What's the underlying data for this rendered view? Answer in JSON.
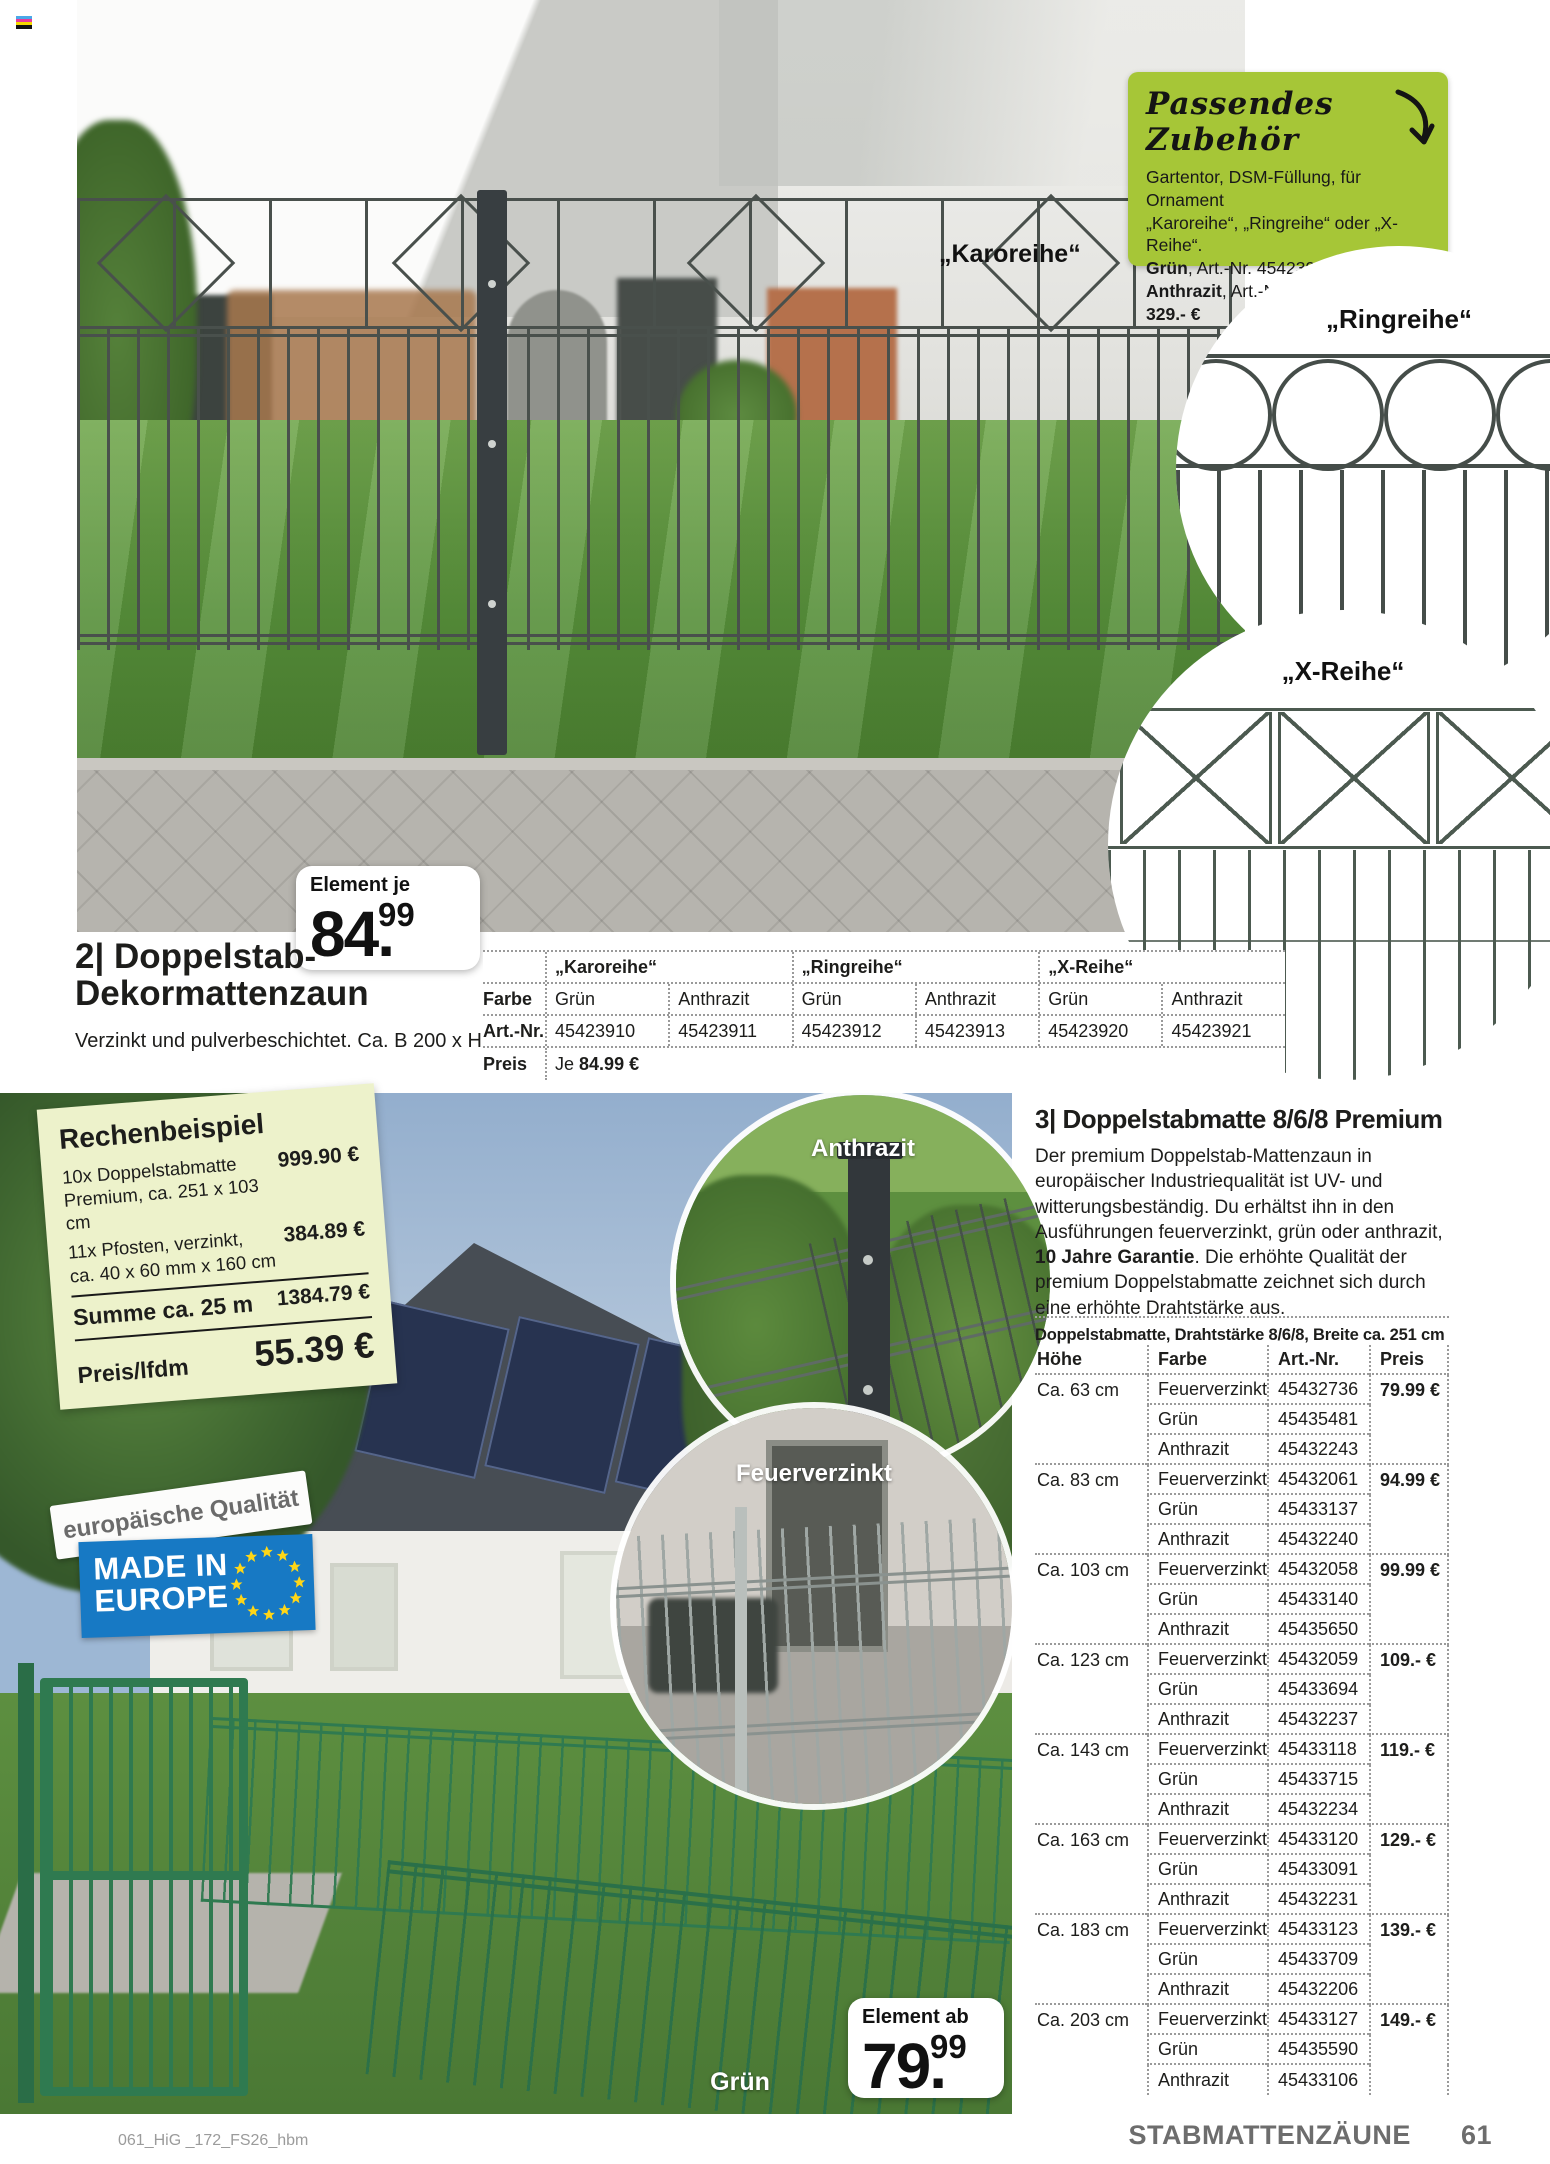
{
  "accent": {
    "lime_green": "#a6c637",
    "eu_blue": "#1779c4",
    "fence_green": "#2f7a50"
  },
  "accessory_box": {
    "title": "Passendes Zubehör",
    "line1": "Gartentor, DSM-Füllung, für Ornament",
    "line2": "„Karoreihe“, „Ringreihe“ oder „X-Reihe“.",
    "green_label": "Grün",
    "green_rest": ", Art.-Nr. 45423922",
    "anthracite_label": "Anthrazit",
    "anthracite_rest": ", Art.-Nr. 45423923, je ",
    "price_bold": "329.- €"
  },
  "photo_labels": {
    "karoreihe": "„Karoreihe“",
    "ringreihe": "„Ringreihe“",
    "xreihe": "„X-Reihe“",
    "anthrazit": "Anthrazit",
    "feuerverzinkt": "Feuerverzinkt",
    "gruen": "Grün"
  },
  "badge1": {
    "label": "Element je",
    "int": "84",
    "dec": "99"
  },
  "badge2": {
    "label": "Element ab",
    "int": "79",
    "dec": "99"
  },
  "product2": {
    "title_line1": "2| Doppelstab-",
    "title_line2": "Dekormattenzaun",
    "subtitle": "Verzinkt und pulverbeschichtet. Ca. B 200 x H 100 cm.",
    "table": {
      "row_labels": {
        "farbe": "Farbe",
        "artnr": "Art.-Nr.",
        "preis": "Preis"
      },
      "groups": [
        "„Karoreihe“",
        "„Ringreihe“",
        "„X-Reihe“"
      ],
      "farbe": [
        "Grün",
        "Anthrazit",
        "Grün",
        "Anthrazit",
        "Grün",
        "Anthrazit"
      ],
      "artnr": [
        "45423910",
        "45423911",
        "45423912",
        "45423913",
        "45423920",
        "45423921"
      ],
      "preis_prefix": "Je ",
      "preis_value": "84.99 €"
    }
  },
  "rechenbeispiel": {
    "title": "Rechenbeispiel",
    "item1_l1": "10x Doppelstabmatte",
    "item1_l2": "Premium, ca. 251 x 103 cm",
    "item1_price": "999.90 €",
    "item2_l1": "11x Pfosten, verzinkt,",
    "item2_l2": "ca. 40 x 60 mm x 160 cm",
    "item2_price": "384.89 €",
    "summe_label": "Summe ca. 25 m",
    "summe_price": "1384.79 €",
    "final_label": "Preis/lfdm",
    "final_price": "55.39 €"
  },
  "quality": {
    "band": "europäische Qualität",
    "badge_line1": "MADE IN",
    "badge_line2": "EUROPE"
  },
  "product3": {
    "title": "3| Doppelstabmatte 8/6/8 Premium",
    "desc_before": "Der premium Doppelstab-Mattenzaun in europäischer Industriequalität ist UV- und witterungsbeständig. Du erhältst ihn in den Ausführungen feuerverzinkt, grün oder anthrazit, ",
    "desc_bold": "10 Jahre Garantie",
    "desc_after": ". Die erhöhte Qualität der premium Doppelstabmatte zeichnet sich durch eine erhöhte Drahtstärke aus.",
    "table_title": "Doppelstabmatte, Drahtstärke 8/6/8, Breite ca. 251 cm",
    "columns": [
      "Höhe",
      "Farbe",
      "Art.-Nr.",
      "Preis"
    ],
    "groups": [
      {
        "hoehe": "Ca. 63 cm",
        "rows": [
          [
            "Feuerverzinkt",
            "45432736",
            "79.99 €"
          ],
          [
            "Grün",
            "45435481",
            ""
          ],
          [
            "Anthrazit",
            "45432243",
            ""
          ]
        ]
      },
      {
        "hoehe": "Ca. 83 cm",
        "rows": [
          [
            "Feuerverzinkt",
            "45432061",
            "94.99 €"
          ],
          [
            "Grün",
            "45433137",
            ""
          ],
          [
            "Anthrazit",
            "45432240",
            ""
          ]
        ]
      },
      {
        "hoehe": "Ca. 103 cm",
        "rows": [
          [
            "Feuerverzinkt",
            "45432058",
            "99.99 €"
          ],
          [
            "Grün",
            "45433140",
            ""
          ],
          [
            "Anthrazit",
            "45435650",
            ""
          ]
        ]
      },
      {
        "hoehe": "Ca. 123 cm",
        "rows": [
          [
            "Feuerverzinkt",
            "45432059",
            "109.- €"
          ],
          [
            "Grün",
            "45433694",
            ""
          ],
          [
            "Anthrazit",
            "45432237",
            ""
          ]
        ]
      },
      {
        "hoehe": "Ca. 143 cm",
        "rows": [
          [
            "Feuerverzinkt",
            "45433118",
            "119.- €"
          ],
          [
            "Grün",
            "45433715",
            ""
          ],
          [
            "Anthrazit",
            "45432234",
            ""
          ]
        ]
      },
      {
        "hoehe": "Ca. 163 cm",
        "rows": [
          [
            "Feuerverzinkt",
            "45433120",
            "129.- €"
          ],
          [
            "Grün",
            "45433091",
            ""
          ],
          [
            "Anthrazit",
            "45432231",
            ""
          ]
        ]
      },
      {
        "hoehe": "Ca. 183 cm",
        "rows": [
          [
            "Feuerverzinkt",
            "45433123",
            "139.- €"
          ],
          [
            "Grün",
            "45433709",
            ""
          ],
          [
            "Anthrazit",
            "45432206",
            ""
          ]
        ]
      },
      {
        "hoehe": "Ca. 203 cm",
        "rows": [
          [
            "Feuerverzinkt",
            "45433127",
            "149.- €"
          ],
          [
            "Grün",
            "45435590",
            ""
          ],
          [
            "Anthrazit",
            "45433106",
            ""
          ]
        ]
      }
    ]
  },
  "footer": {
    "left": "061_HiG _172_FS26_hbm",
    "section": "STABMATTENZÄUNE",
    "page_number": "61"
  }
}
